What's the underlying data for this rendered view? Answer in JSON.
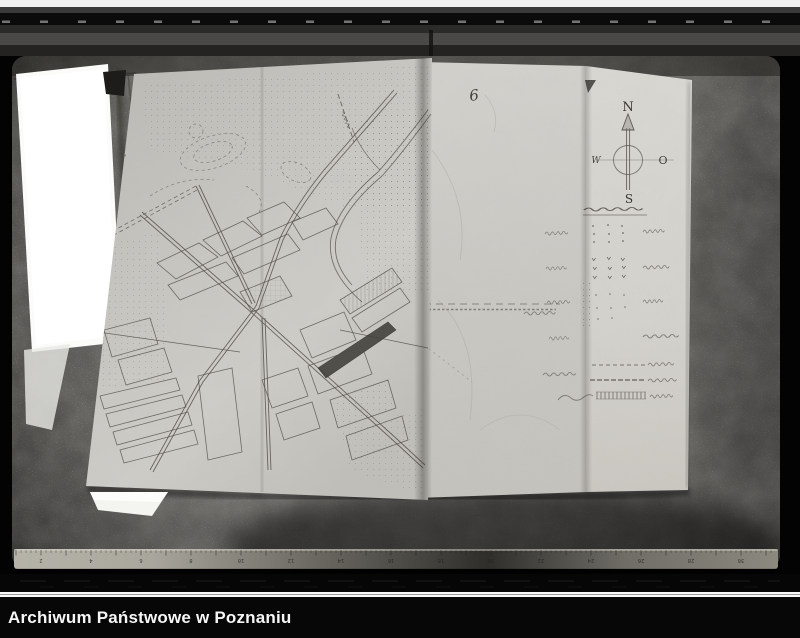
{
  "caption_bar": {
    "text": "Archiwum Państwowe w Poznaniu"
  },
  "document": {
    "page_number": "6",
    "compass": {
      "north": "N",
      "east": "O",
      "south": "S",
      "west": "W"
    },
    "legend": {
      "rows": [
        {
          "symbol": "sparse-dot-grid"
        },
        {
          "symbol": "small-tick-grid"
        },
        {
          "symbol": "dot-grid"
        },
        {
          "symbol": "handwritten-label-only"
        },
        {
          "symbol": "dashed-boundary-line"
        },
        {
          "symbol": "dot-dash-boundary-line"
        },
        {
          "symbol": "railway-hatched-band"
        }
      ]
    }
  },
  "ruler": {
    "numbers": [
      "2",
      "4",
      "6",
      "8",
      "10",
      "12",
      "14",
      "16",
      "18",
      "20",
      "22",
      "24",
      "26",
      "28",
      "30"
    ]
  }
}
